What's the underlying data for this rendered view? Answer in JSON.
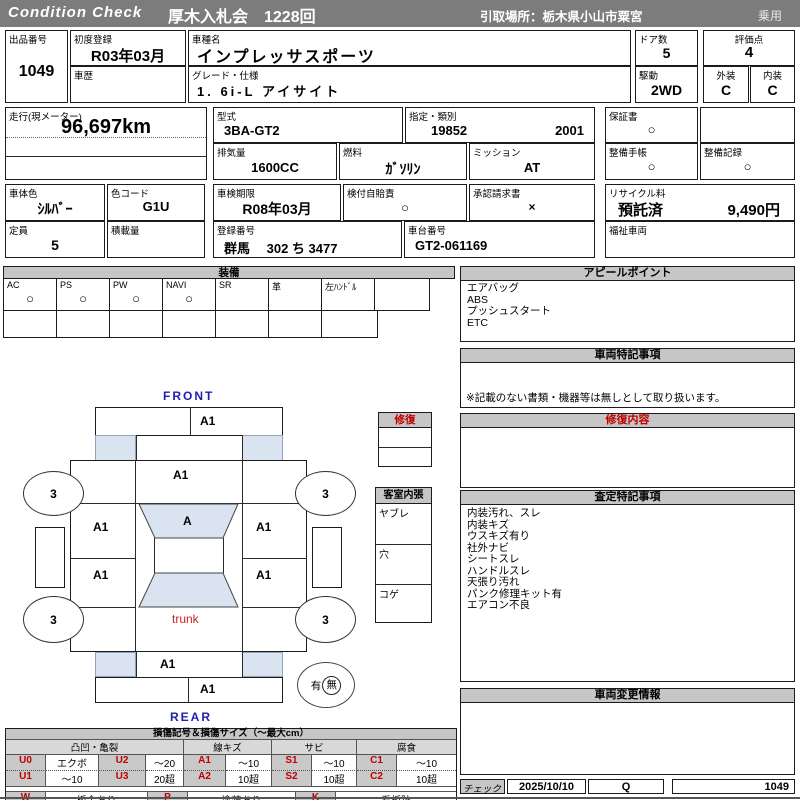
{
  "header": {
    "brand": "Condition  Check",
    "auction": "厚木入札会　1228回",
    "pickup": "引取場所：栃木県小山市粟宮",
    "category": "乗用"
  },
  "info": {
    "lot_label": "出品番号",
    "lot": "1049",
    "first_reg_label": "初度登録",
    "first_reg": "R03年03月",
    "history_label": "車歴",
    "model_label": "車種名",
    "model": "インプレッサスポーツ",
    "grade_label": "グレード・仕様",
    "grade": "1. 6i-L アイサイト",
    "doors_label": "ドア数",
    "doors": "5",
    "score_label": "評価点",
    "score": "4",
    "drive_label": "駆動",
    "drive": "2WD",
    "exterior_label": "外装",
    "exterior": "C",
    "interior_label": "内装",
    "interior": "C",
    "odo_label": "走行(現メーター)",
    "odo": "96,697km",
    "type_label": "型式",
    "type": "3BA-GT2",
    "class_label": "指定・類別",
    "class1": "19852",
    "class2": "2001",
    "warranty_label": "保証書",
    "warranty": "○",
    "disp_label": "排気量",
    "disp": "1600CC",
    "fuel_label": "燃料",
    "fuel": "ｶﾞｿﾘﾝ",
    "mission_label": "ミッション",
    "mission": "AT",
    "book_label": "整備手帳",
    "book": "○",
    "record_label": "整備記録",
    "record": "○",
    "color_label": "車体色",
    "color": "ｼﾙﾊﾞｰ",
    "colorcode_label": "色コード",
    "colorcode": "G1U",
    "inspection_label": "車検期限",
    "inspection": "R08年03月",
    "insurance_label": "検付自賠責",
    "insurance": "○",
    "approval_label": "承認請求書",
    "approval": "×",
    "recycle_label": "リサイクル料",
    "recycle_status": "預託済",
    "recycle_fee": "9,490円",
    "capacity_label": "定員",
    "capacity": "5",
    "load_label": "積載量",
    "plate_label": "登録番号",
    "plate": "群馬　 302 ち 3477",
    "vin_label": "車台番号",
    "vin": "GT2-061169",
    "welfare_label": "福祉車両"
  },
  "equipment": {
    "title": "装備",
    "items": [
      {
        "label": "AC",
        "value": "○"
      },
      {
        "label": "PS",
        "value": "○"
      },
      {
        "label": "PW",
        "value": "○"
      },
      {
        "label": "NAVI",
        "value": "○"
      },
      {
        "label": "SR",
        "value": ""
      },
      {
        "label": "革",
        "value": ""
      },
      {
        "label": "左ﾊﾝﾄﾞﾙ",
        "value": ""
      },
      {
        "label": "",
        "value": ""
      }
    ]
  },
  "panels": {
    "appeal_title": "アピールポイント",
    "appeal_items": [
      "エアバッグ",
      "ABS",
      "プッシュスタート",
      "ETC"
    ],
    "notes_title": "車両特記事項",
    "notes_footer": "※記載のない書類・機器等は無しとして取り扱います。",
    "repair_title": "修復内容",
    "assessment_title": "査定特記事項",
    "assessment_items": [
      "内装汚れ、スレ",
      "内装キズ",
      "ウスキズ有り",
      "社外ナビ",
      "シートスレ",
      "ハンドルスレ",
      "天張り汚れ",
      "パンク修理キット有",
      "エアコン不良"
    ],
    "change_title": "車両変更情報"
  },
  "repair_box": {
    "title": "修復"
  },
  "interior_box": {
    "title": "客室内張",
    "items": [
      "ヤブレ",
      "穴",
      "コゲ"
    ]
  },
  "diagram": {
    "front": "FRONT",
    "rear": "REAR",
    "trunk": "trunk",
    "presence": {
      "yes": "有",
      "no": "無"
    },
    "marks": {
      "front_bumper": "A1",
      "hood": "A1",
      "windshield": "A",
      "front_left_fender": "A1",
      "front_right_fender": "A1",
      "left_door": "A1",
      "right_door": "A1",
      "rear_panel": "A1",
      "rear_bumper": "A1",
      "wheel_front_left": "3",
      "wheel_front_right": "3",
      "wheel_rear_left": "3",
      "wheel_rear_right": "3"
    }
  },
  "legend": {
    "title": "損傷記号＆損傷サイズ（～最大cm）",
    "groups": [
      "凸凹・亀裂",
      "線キズ",
      "サビ",
      "腐食"
    ],
    "rows": [
      [
        "U0",
        "エクボ",
        "U2",
        "～20",
        "A1",
        "～10",
        "S1",
        "～10",
        "C1",
        "～10"
      ],
      [
        "U1",
        "～10",
        "U3",
        "20超",
        "A2",
        "10超",
        "S2",
        "10超",
        "C2",
        "10超"
      ]
    ],
    "rows2": [
      [
        "W",
        "板金あり",
        "P",
        "塗装あり",
        "K",
        "看板跡"
      ],
      [
        "X",
        "交換跡",
        "G",
        "ガラス交換要す",
        "L",
        "レンズ割れ"
      ]
    ]
  },
  "footer": {
    "check_label": "チェック",
    "date": "2025/10/10",
    "inspector": "Q",
    "lot": "1049"
  }
}
